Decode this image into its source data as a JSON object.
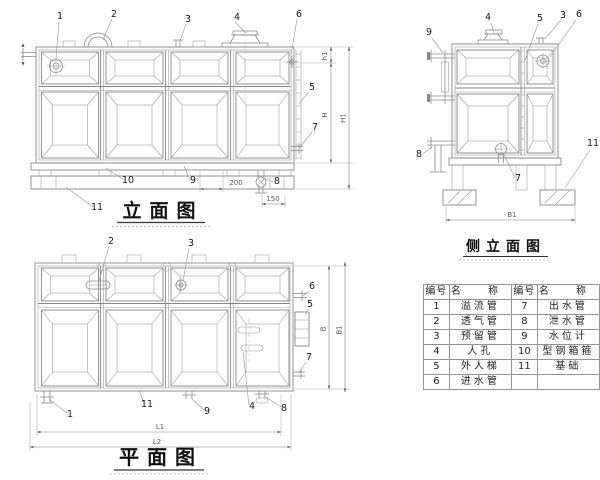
{
  "titles": {
    "elevation": "立面图",
    "side": "侧立面图",
    "plan": "平面图"
  },
  "nums": {
    "n1": "1",
    "n2": "2",
    "n3": "3",
    "n4": "4",
    "n5": "5",
    "n6": "6",
    "n7": "7",
    "n8": "8",
    "n9": "9",
    "n10": "10",
    "n11": "11"
  },
  "dims": {
    "d200": "200",
    "d150": "150",
    "h1": "h1",
    "H": "H",
    "H1": "H1",
    "B": "B",
    "B1": "B1",
    "L1": "L1",
    "L2": "L2"
  },
  "table": {
    "headers": [
      "编号",
      "名 称",
      "编号",
      "名 称"
    ],
    "rows": [
      [
        "1",
        "溢流管",
        "7",
        "出水管"
      ],
      [
        "2",
        "透气管",
        "8",
        "泄水管"
      ],
      [
        "3",
        "预留管",
        "9",
        "水位计"
      ],
      [
        "4",
        "人孔",
        "10",
        "型钢箱箍"
      ],
      [
        "5",
        "外人梯",
        "11",
        "基础"
      ],
      [
        "6",
        "进水管",
        "",
        ""
      ]
    ]
  }
}
